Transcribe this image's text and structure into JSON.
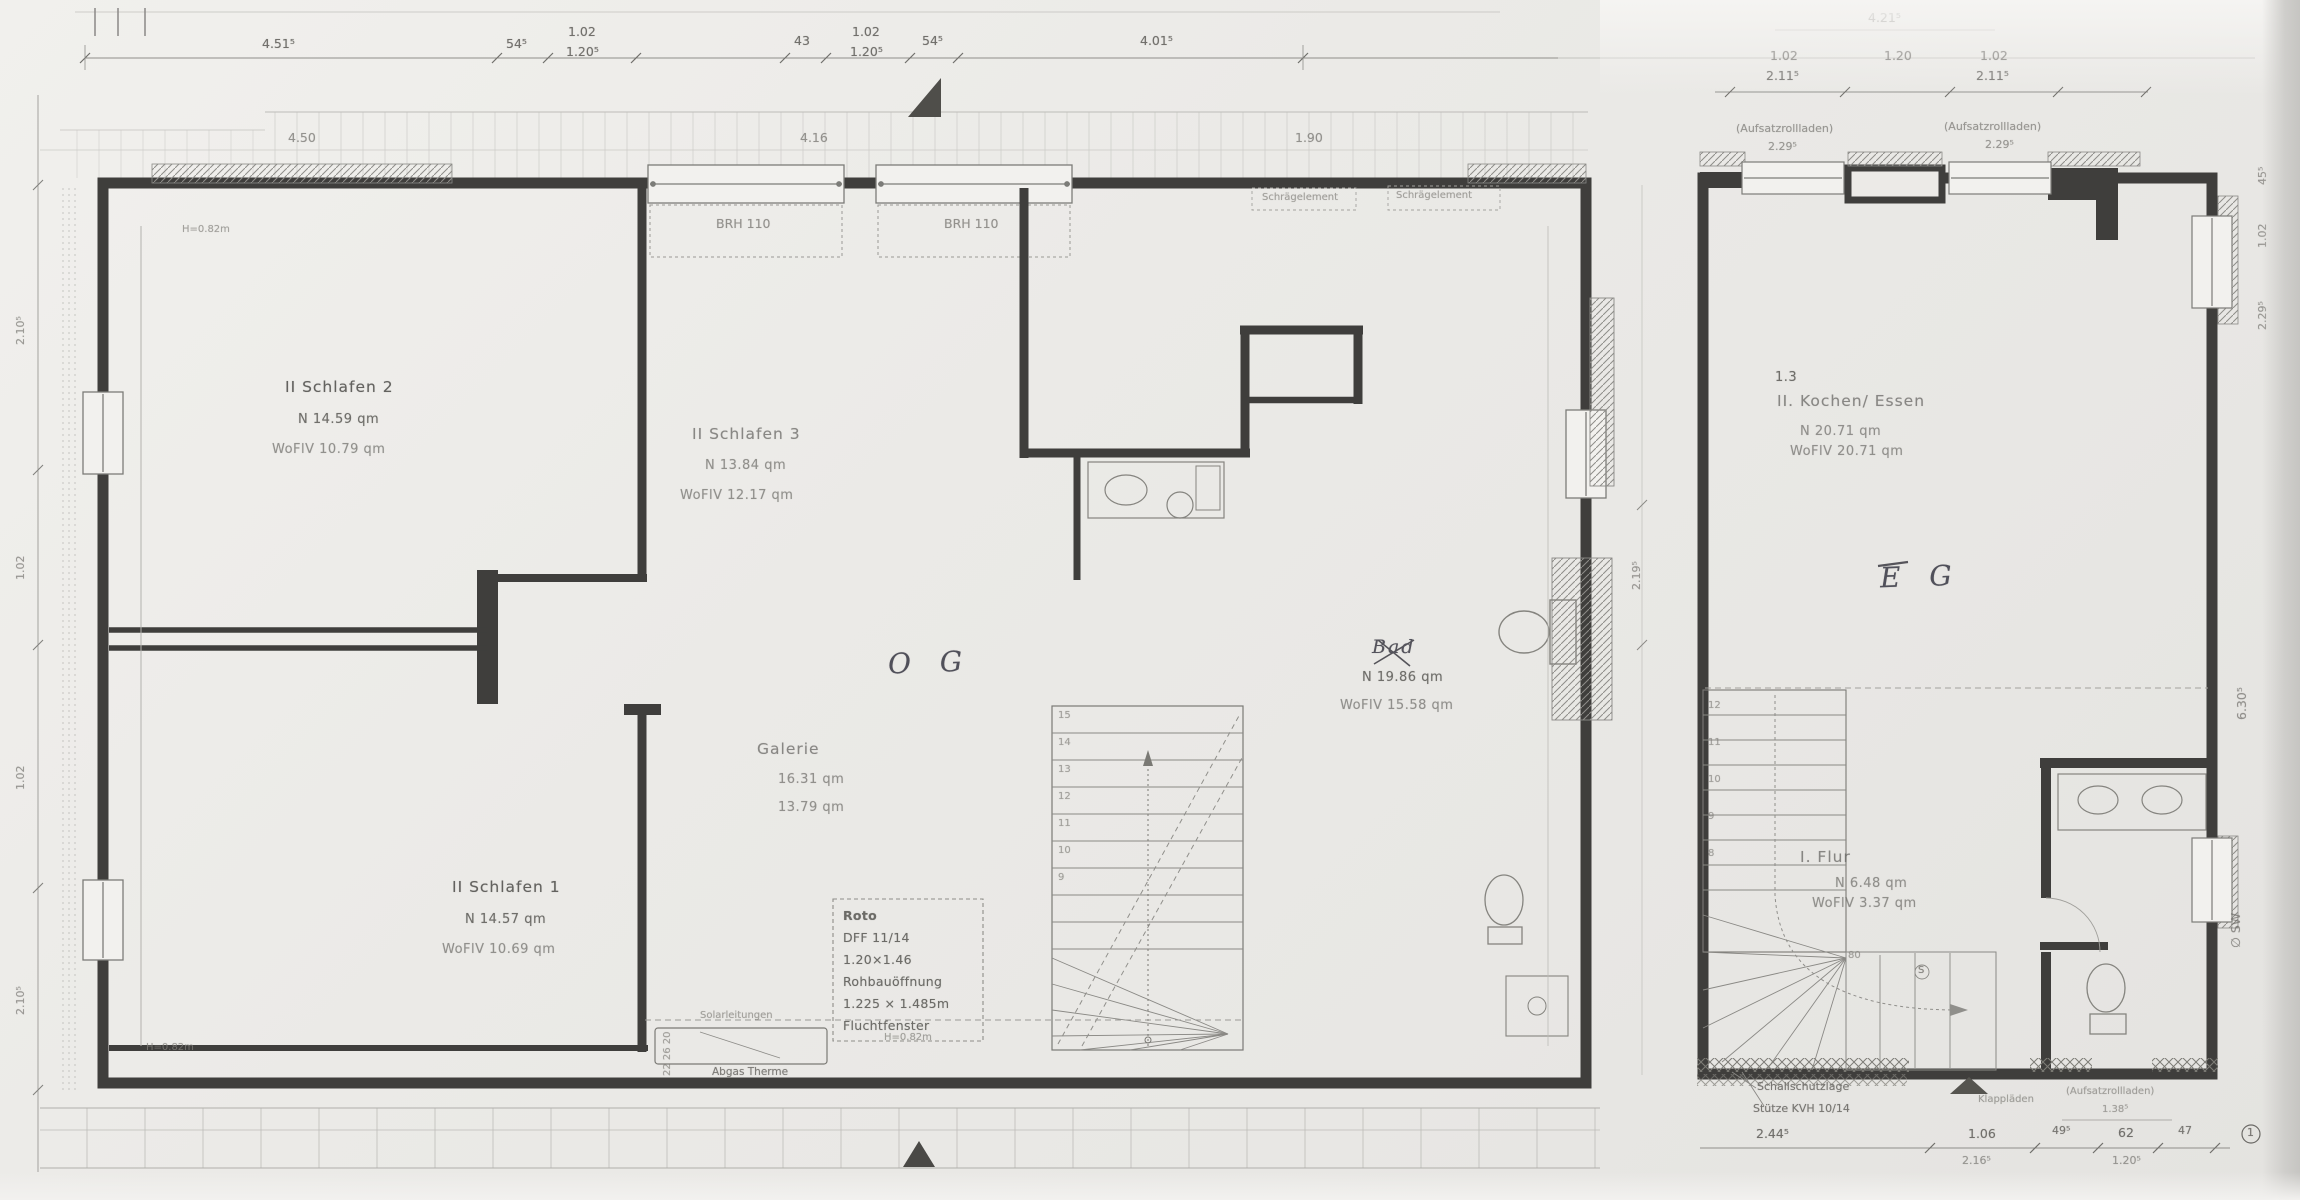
{
  "og": {
    "title_handwritten": "O G",
    "rooms": [
      {
        "name": "II  Schlafen 2",
        "line2": "N   14.59   qm",
        "line3": "WoFlV   10.79   qm"
      },
      {
        "name": "II  Schlafen 3",
        "line2": "N   13.84   qm",
        "line3": "WoFlV   12.17   qm"
      },
      {
        "name": "II  Schlafen 1",
        "line2": "N   14.57   qm",
        "line3": "WoFlV   10.69   qm"
      },
      {
        "name": "Galerie",
        "line2": "16.31   qm",
        "line3": "13.79   qm"
      },
      {
        "name": "Bad",
        "line2": "N   19.86   qm",
        "line3": "WoFlV   15.58   qm"
      }
    ],
    "windows": [
      "BRH 110",
      "BRH 110"
    ],
    "roof_labels": [
      "Schrägelement",
      "Schrägelement"
    ],
    "roto": [
      "Roto",
      "DFF 11/14",
      "1.20×1.46",
      "Rohbauöffnung",
      "1.225 × 1.485m",
      "Fluchtfenster"
    ],
    "notes": {
      "solar": "Solarleitungen",
      "therme": "Abgas Therme",
      "therme_dim": "22  26  20",
      "h_mid": "H=0.82m",
      "h_left_top": "H=0.82m",
      "h_left_bottom": "H=0.82m"
    },
    "stairs": [
      "15",
      "14",
      "13",
      "12",
      "11",
      "10",
      "9"
    ],
    "dims_top": [
      {
        "label": "4.51⁵"
      },
      {
        "label": "54⁵"
      },
      {
        "top": "1.02",
        "bottom": "1.20⁵"
      },
      {
        "label": "43"
      },
      {
        "top": "1.02",
        "bottom": "1.20⁵"
      },
      {
        "label": "54⁵"
      },
      {
        "label": "4.01⁵"
      }
    ],
    "dims_band": [
      "4.50",
      "4.16",
      "1.90"
    ],
    "dims_left": [
      "2.10⁵",
      "1.02",
      "1.02",
      "2.10⁵"
    ]
  },
  "eg": {
    "title_handwritten": "E G",
    "rooms": [
      {
        "code": "1.3",
        "name": "II. Kochen/ Essen",
        "line2": "N   20.71   qm",
        "line3": "WoFlV  20.71   qm"
      },
      {
        "name": "I. Flur",
        "line2": "N   6.48   qm",
        "line3": "WoFlV  3.37   qm"
      }
    ],
    "rollladen_top": [
      {
        "label": "(Aufsatzrollladen)",
        "dim": "2.29⁵"
      },
      {
        "label": "(Aufsatzrollladen)",
        "dim": "2.29⁵"
      }
    ],
    "dims_top": {
      "row1": "4.21⁵",
      "row2": [
        {
          "top": "1.02",
          "bottom": "2.11⁵"
        },
        {
          "top": "1.20",
          "bottom": ""
        },
        {
          "top": "1.02",
          "bottom": "2.11⁵"
        }
      ]
    },
    "dims_right": [
      "45⁵",
      "1.02",
      "2.29⁵",
      "6.30⁵"
    ],
    "sw_label": "∅ SW",
    "dims_between": "2.19⁵",
    "stairs": [
      "12",
      "11",
      "10",
      "9",
      "8"
    ],
    "stair_notes": {
      "r80": "80",
      "s": "S"
    },
    "bottom": {
      "schallschutz1": "Schallschutzlage",
      "schallschutz2": "Stütze KVH 10/14",
      "klapp": "Klappläden",
      "rollladen": "(Aufsatzrollladen)",
      "rollladen_dim": "1.38⁵",
      "dims_row1": [
        "2.44⁵",
        "1.06",
        "49⁵",
        "62",
        "47"
      ],
      "dims_row2": [
        "2.16⁵",
        "1.20⁵"
      ],
      "circle_mark": "1"
    }
  }
}
